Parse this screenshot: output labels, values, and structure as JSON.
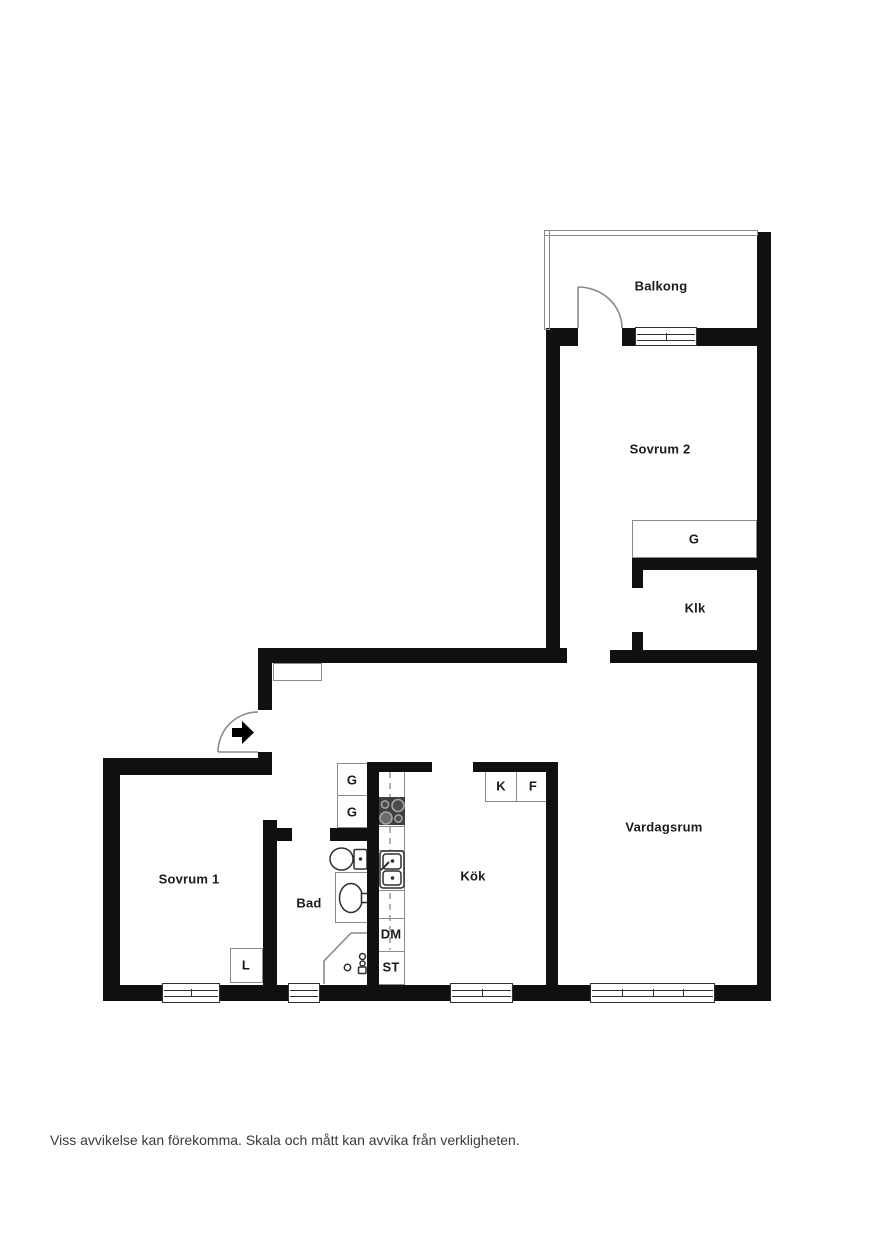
{
  "floorplan": {
    "labels": {
      "balcony": "Balkong",
      "bedroom2": "Sovrum 2",
      "wardrobe_bedroom2": "G",
      "walk_in_closet": "Klk",
      "living_room": "Vardagsrum",
      "kitchen": "Kök",
      "bedroom1": "Sovrum 1",
      "bathroom": "Bad",
      "hall_wardrobe_1": "G",
      "hall_wardrobe_2": "G",
      "fridge": "K",
      "freezer": "F",
      "dishwasher": "DM",
      "tall_cabinet": "ST",
      "linen_closet": "L"
    },
    "disclaimer": "Viss avvikelse kan förekomma. Skala och mått kan avvika från verkligheten.",
    "colors": {
      "wall": "#101010",
      "furniture_outline": "#8a8a8a",
      "fixture_stroke": "#2f2f2f",
      "hob_fill": "#3f3f3f",
      "text": "#1b1b1b",
      "disclaimer_text": "#3a3a3a",
      "background": "#ffffff"
    }
  }
}
